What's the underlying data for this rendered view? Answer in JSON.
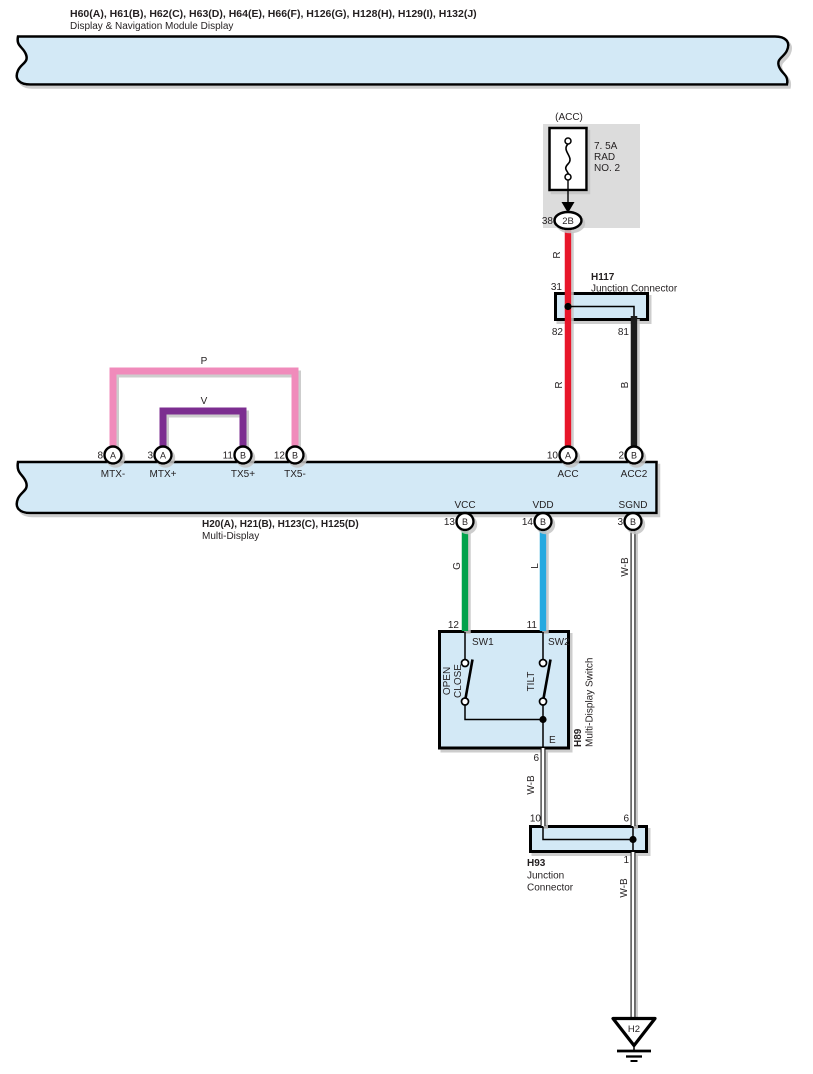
{
  "header": {
    "line1": "H60(A), H61(B), H62(C), H63(D), H64(E), H66(F), H126(G), H128(H), H129(I), H132(J)",
    "line2": "Display & Navigation Module Display"
  },
  "fuse": {
    "source_label": "(ACC)",
    "rating_line1": "7. 5A",
    "rating_line2": "RAD",
    "rating_line3": "NO. 2",
    "pin": "38",
    "connector_code": "2B"
  },
  "h117": {
    "id": "H117",
    "type": "Junction Connector",
    "pin_top": "31",
    "pin_bottom_left": "82",
    "pin_bottom_right": "81"
  },
  "wire_labels": {
    "r_upper": "R",
    "r_lower": "R",
    "b": "B",
    "p": "P",
    "v": "V",
    "g": "G",
    "l": "L",
    "wb_sgnd": "W-B",
    "wb_switch": "W-B",
    "wb_ground": "W-B"
  },
  "multi_display": {
    "id_line": "H20(A), H21(B), H123(C), H125(D)",
    "name": "Multi-Display",
    "top_pins": [
      {
        "num": "8",
        "conn": "A",
        "signal": "MTX-"
      },
      {
        "num": "3",
        "conn": "A",
        "signal": "MTX+"
      },
      {
        "num": "11",
        "conn": "B",
        "signal": "TX5+"
      },
      {
        "num": "12",
        "conn": "B",
        "signal": "TX5-"
      },
      {
        "num": "10",
        "conn": "A",
        "signal": "ACC"
      },
      {
        "num": "2",
        "conn": "B",
        "signal": "ACC2"
      }
    ],
    "bottom_pins": [
      {
        "num": "13",
        "conn": "B",
        "signal": "VCC"
      },
      {
        "num": "14",
        "conn": "B",
        "signal": "VDD"
      },
      {
        "num": "3",
        "conn": "B",
        "signal": "SGND"
      }
    ]
  },
  "switch": {
    "id": "H89",
    "name": "Multi-Display Switch",
    "pin_sw1": "12",
    "pin_sw2": "11",
    "sw1": "SW1",
    "sw2": "SW2",
    "sw1_action_line1": "OPEN",
    "sw1_action_line2": "CLOSE",
    "sw2_action": "TILT",
    "pin_e": "E",
    "pin_out": "6"
  },
  "h93": {
    "id": "H93",
    "type_line1": "Junction",
    "type_line2": "Connector",
    "pin_top_left": "10",
    "pin_top_right": "6",
    "pin_bottom": "1"
  },
  "ground": {
    "id": "H2"
  },
  "colors": {
    "band_fill": "#d3e9f6",
    "fuse_box_bg": "#dcdcdc",
    "wire_red": "#e8192c",
    "wire_black": "#1a1a1a",
    "wire_pink": "#f08bbb",
    "wire_purple": "#7c2e90",
    "wire_green": "#00a24b",
    "wire_blue": "#25a9e0",
    "shadow": "#c4c4c4"
  }
}
